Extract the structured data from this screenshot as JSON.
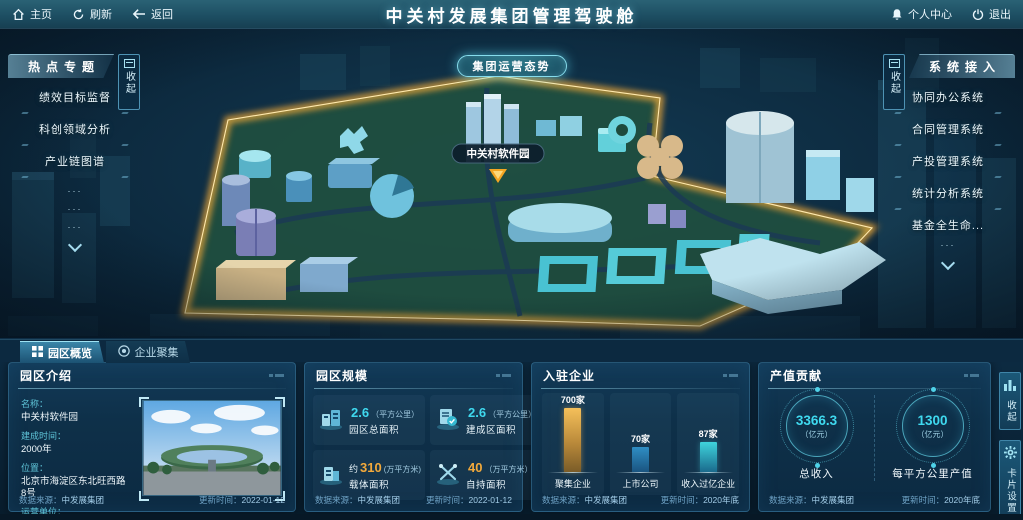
{
  "topbar": {
    "home": "主页",
    "refresh": "刷新",
    "back": "返回",
    "title": "中关村发展集团管理驾驶舱",
    "profile": "个人中心",
    "logout": "退出"
  },
  "map": {
    "situation_button": "集团运营态势",
    "marker_label": "中关村软件园"
  },
  "left_panel": {
    "title": "热点专题",
    "collapse": "收起",
    "items": [
      "绩效目标监督",
      "科创领域分析",
      "产业链图谱"
    ],
    "more": [
      "···",
      "···",
      "···"
    ]
  },
  "right_panel": {
    "title": "系统接入",
    "collapse": "收起",
    "items": [
      "协同办公系统",
      "合同管理系统",
      "产投管理系统",
      "统计分析系统",
      "基金全生命..."
    ],
    "more": [
      "···"
    ]
  },
  "tabs": {
    "overview": "园区概览",
    "cluster": "企业聚集"
  },
  "panels": {
    "intro": {
      "title": "园区介绍",
      "fields": [
        {
          "label": "名称：",
          "value": "中关村软件园"
        },
        {
          "label": "建成时间：",
          "value": "2000年"
        },
        {
          "label": "位置：",
          "value": "北京市海淀区东北旺西路8号"
        },
        {
          "label": "运营单位：",
          "value": "北京中关村软件园发展有限公司"
        }
      ],
      "source_label": "数据来源：",
      "source": "中发展集团",
      "updated_label": "更新时间：",
      "updated": "2022-01-12"
    },
    "scale": {
      "title": "园区规模",
      "stats": [
        {
          "prefix": "",
          "value": "2.6",
          "unit": "（平方公里）",
          "label": "园区总面积",
          "accent": "cyan"
        },
        {
          "prefix": "",
          "value": "2.6",
          "unit": "（平方公里）",
          "label": "建成区面积",
          "accent": "cyan"
        },
        {
          "prefix": "约",
          "value": "310",
          "unit": "(万平方米)",
          "label": "载体面积",
          "accent": "orange"
        },
        {
          "prefix": "",
          "value": "40",
          "unit": "（万平方米）",
          "label": "自持面积",
          "accent": "orange"
        }
      ],
      "source_label": "数据来源：",
      "source": "中发展集团",
      "updated_label": "更新时间：",
      "updated": "2022-01-12"
    },
    "enterprises": {
      "title": "入驻企业",
      "bars": [
        {
          "value_label": "700家",
          "category": "聚集企业"
        },
        {
          "value_label": "70家",
          "category": "上市公司"
        },
        {
          "value_label": "87家",
          "category": "收入过亿企业"
        }
      ],
      "source_label": "数据来源：",
      "source": "中发展集团",
      "updated_label": "更新时间：",
      "updated": "2020年底"
    },
    "output": {
      "title": "产值贡献",
      "gauges": [
        {
          "value": "3366.3",
          "unit": "（亿元）",
          "label": "总收入"
        },
        {
          "value": "1300",
          "unit": "（亿元）",
          "label": "每平方公里产值"
        }
      ],
      "source_label": "数据来源：",
      "source": "中发展集团",
      "updated_label": "更新时间：",
      "updated": "2020年底"
    }
  },
  "side_buttons": {
    "collapse": "收起",
    "settings": "卡片设置"
  },
  "chart_data": [
    {
      "type": "bar",
      "title": "入驻企业",
      "categories": [
        "聚集企业",
        "上市公司",
        "收入过亿企业"
      ],
      "values": [
        700,
        70,
        87
      ],
      "value_labels": [
        "700家",
        "70家",
        "87家"
      ],
      "unit": "家",
      "colors": [
        "#e8b04a",
        "#2f86c0",
        "#35d0d8"
      ],
      "legend": false,
      "grid": false
    },
    {
      "type": "gauge",
      "title": "产值贡献",
      "categories": [
        "总收入",
        "每平方公里产值"
      ],
      "values": [
        3366.3,
        1300
      ],
      "unit": "亿元"
    }
  ],
  "colors": {
    "accent_cyan": "#3fd9ef",
    "accent_orange": "#f2a93b",
    "boundary_gold": "#f5b942",
    "panel_bg": "#0e3049",
    "topbar_teal": "#1c4d61"
  }
}
